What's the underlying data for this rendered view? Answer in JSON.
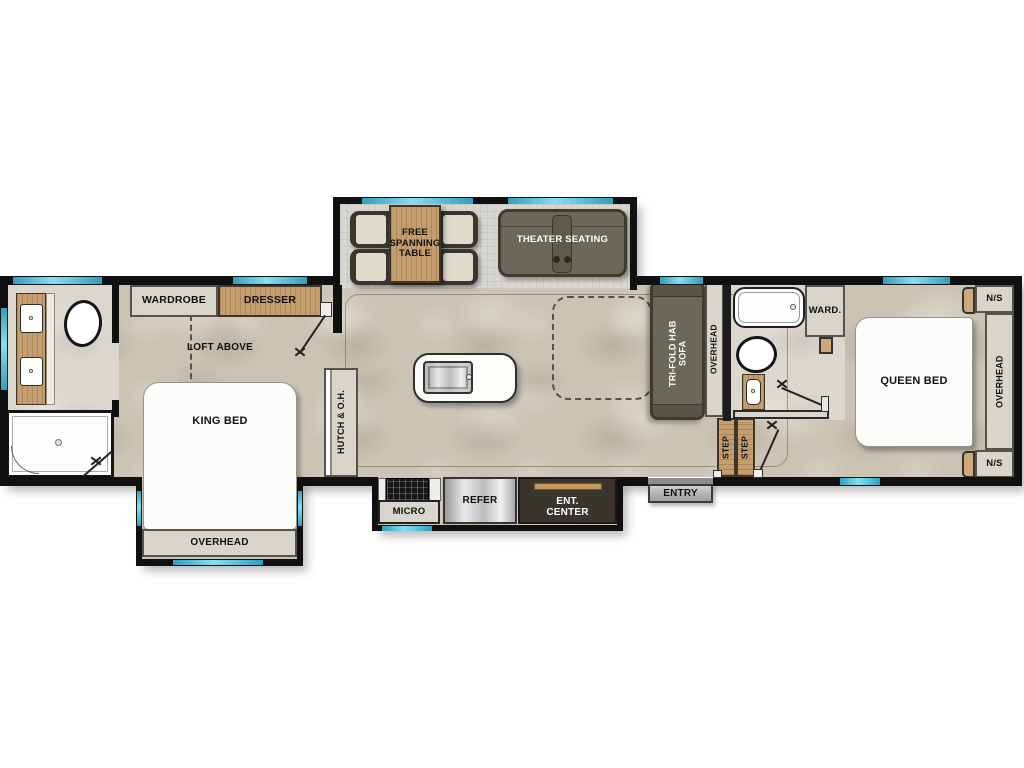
{
  "plan_title": "RV travel trailer floor plan",
  "palette": {
    "wall": "#101010",
    "window_teal": "#45c3de",
    "floor_beige": "#cbc4b5",
    "slide_floor_gray": "#d8d6d0",
    "bath_floor": "#dbd7cf",
    "wood": "#c59e6f",
    "cabinet_gray": "#d8d5cb",
    "furniture_olive": "#6b675a",
    "dark_unit": "#39352c",
    "wood_trim": "#c79a5f"
  },
  "labels": {
    "wardrobe": "WARDROBE",
    "dresser": "DRESSER",
    "loft": "LOFT ABOVE",
    "king_bed": "KING BED",
    "overhead": "OVERHEAD",
    "hutch": "HUTCH & O.H.",
    "free_table": "FREE\nSPANNING\nTABLE",
    "theater": "THEATER SEATING",
    "trifold": "TRI-FOLD HAB\nSOFA",
    "ward": "WARD.",
    "step": "STEP",
    "entry": "ENTRY",
    "micro": "MICRO",
    "refer": "REFER",
    "ent_center": "ENT.\nCENTER",
    "queen_bed": "QUEEN BED",
    "ns": "N/S"
  }
}
